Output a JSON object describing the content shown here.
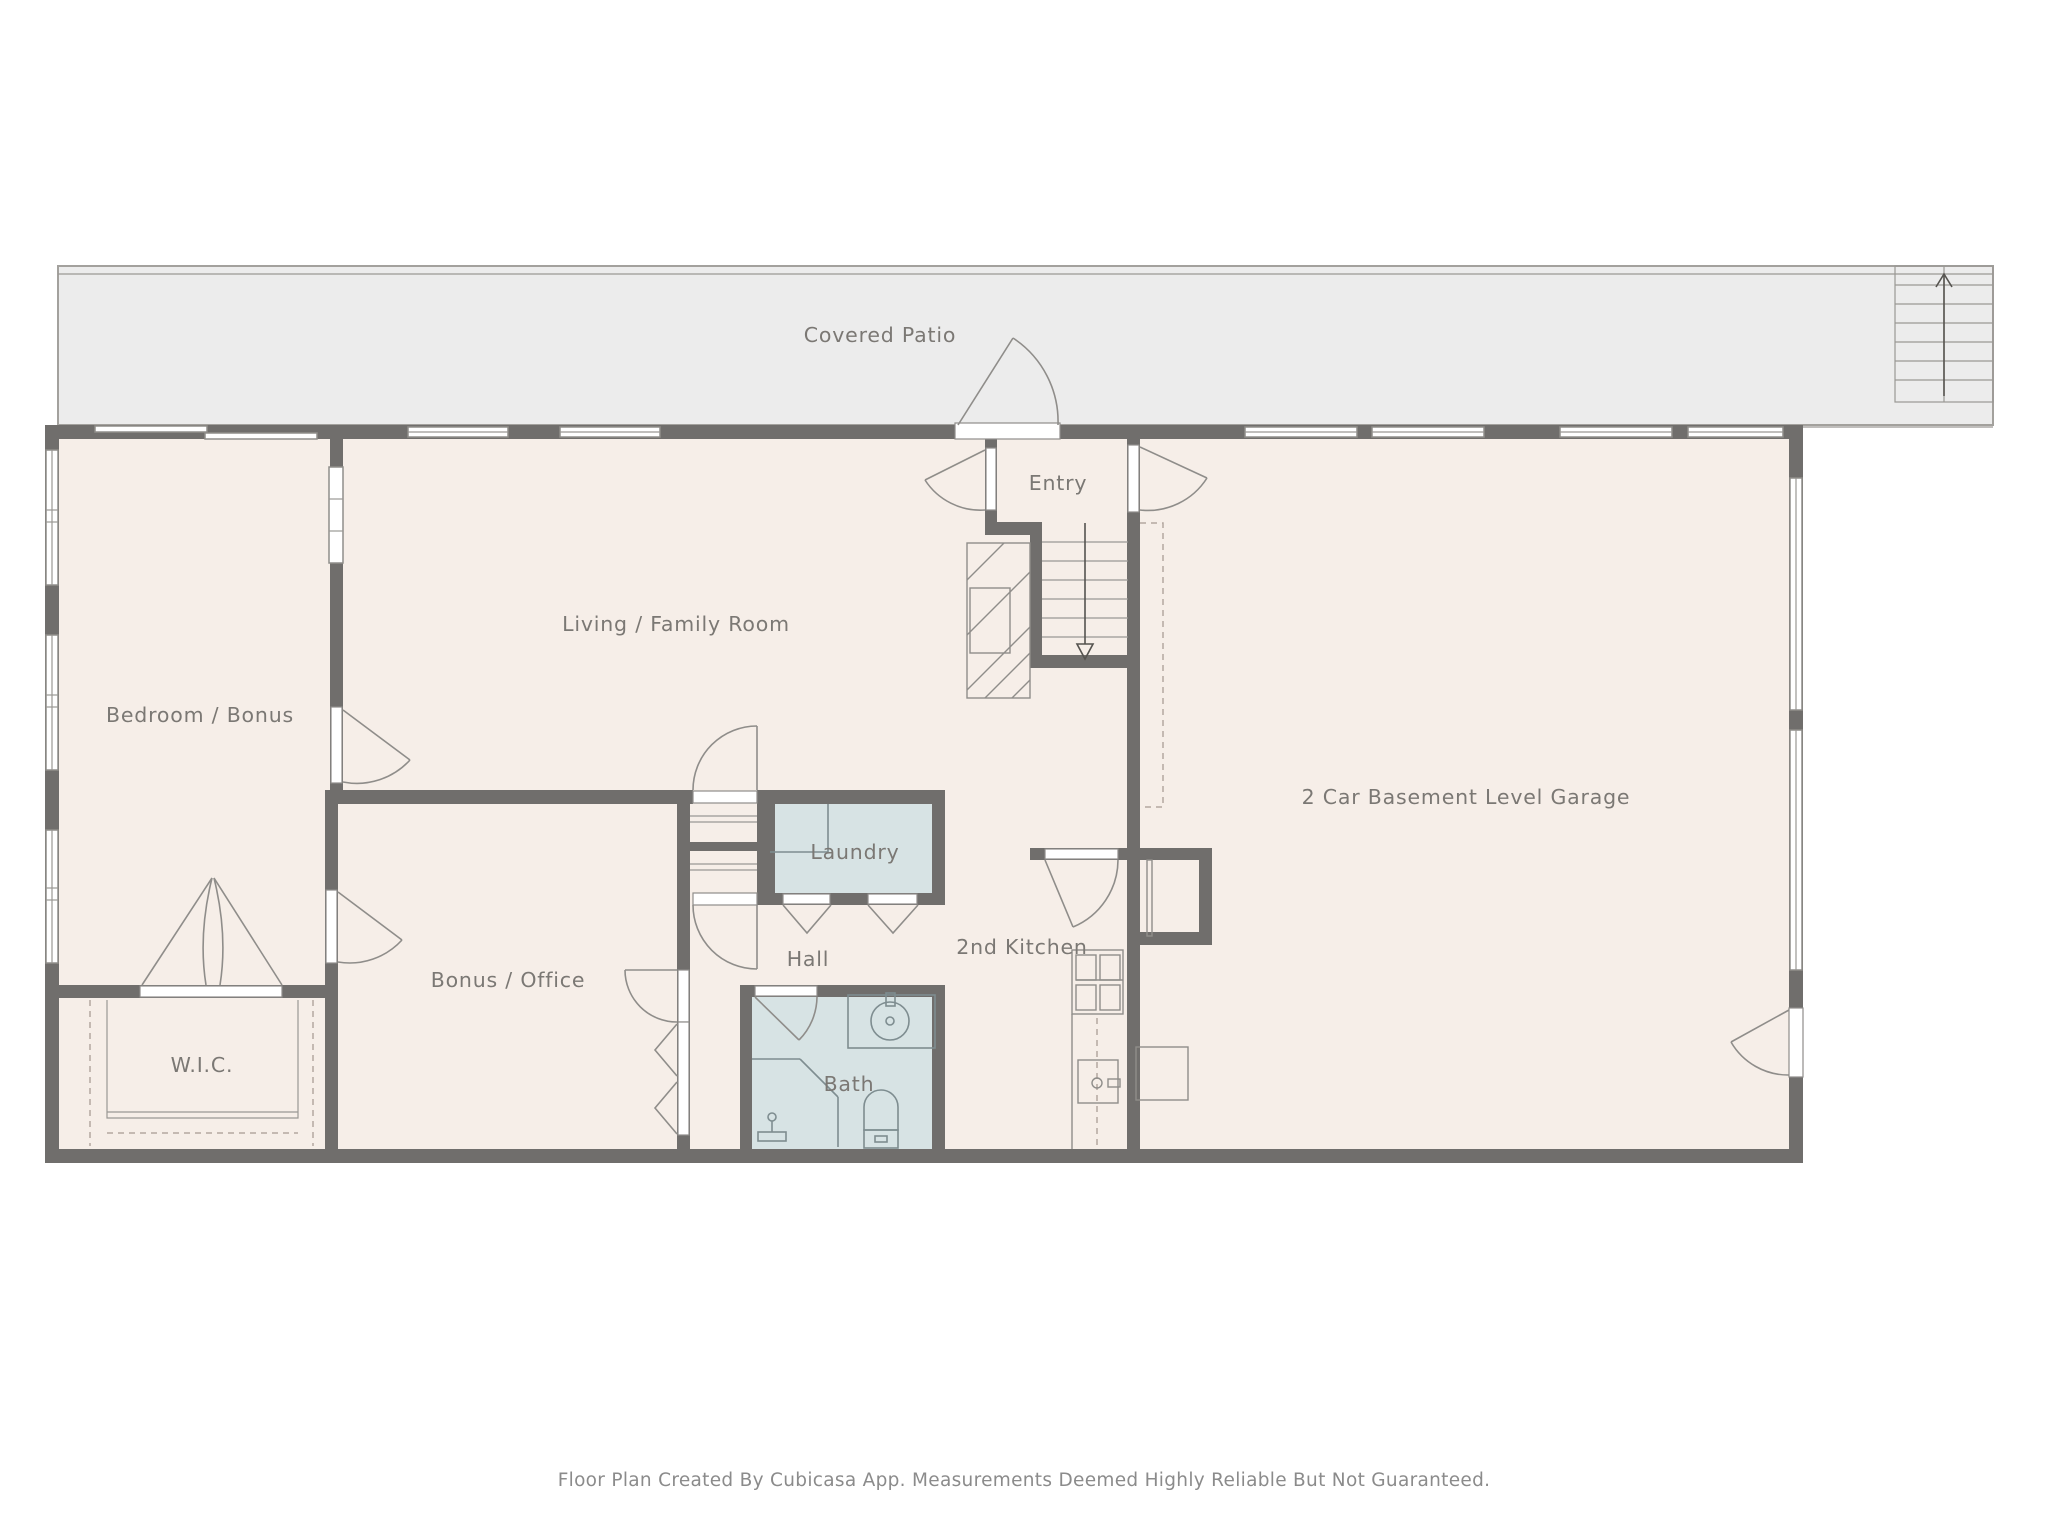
{
  "patio": {
    "label": "Covered Patio"
  },
  "rooms": [
    {
      "label": "Bedroom / Bonus"
    },
    {
      "label": "Living / Family Room"
    },
    {
      "label": "Entry"
    },
    {
      "label": "Laundry"
    },
    {
      "label": "Hall"
    },
    {
      "label": "2nd Kitchen"
    },
    {
      "label": "Bonus / Office"
    },
    {
      "label": "W.I.C."
    },
    {
      "label": "Bath"
    },
    {
      "label": "2 Car Basement Level Garage"
    }
  ],
  "footer": {
    "text": "Floor Plan Created By Cubicasa App. Measurements Deemed Highly Reliable But Not Guaranteed."
  },
  "colors": {
    "wall": "#706e6c",
    "room_fill": "#f6eee8",
    "wet_room_fill": "#d7e3e4",
    "patio_fill": "#ececec",
    "label_text": "#7b7874",
    "footer_text": "#8b8b8b",
    "fixture_line": "#8f8d8a"
  }
}
